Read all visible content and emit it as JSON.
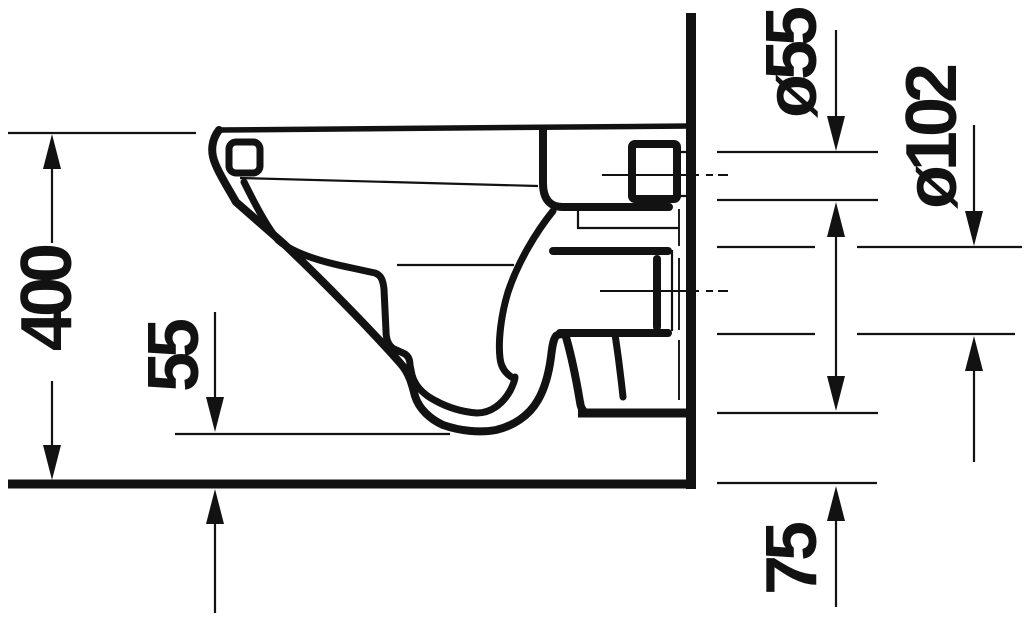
{
  "drawing": {
    "type": "technical-dimension-drawing",
    "subject": "wall-hung-toilet-side-section",
    "labels": {
      "height": "400",
      "floor_gap": "55",
      "inlet_diameter": "ø55",
      "outlet_diameter": "ø102",
      "bottom_height": "75"
    },
    "colors": {
      "line": "#121212",
      "background": "#ffffff"
    }
  }
}
